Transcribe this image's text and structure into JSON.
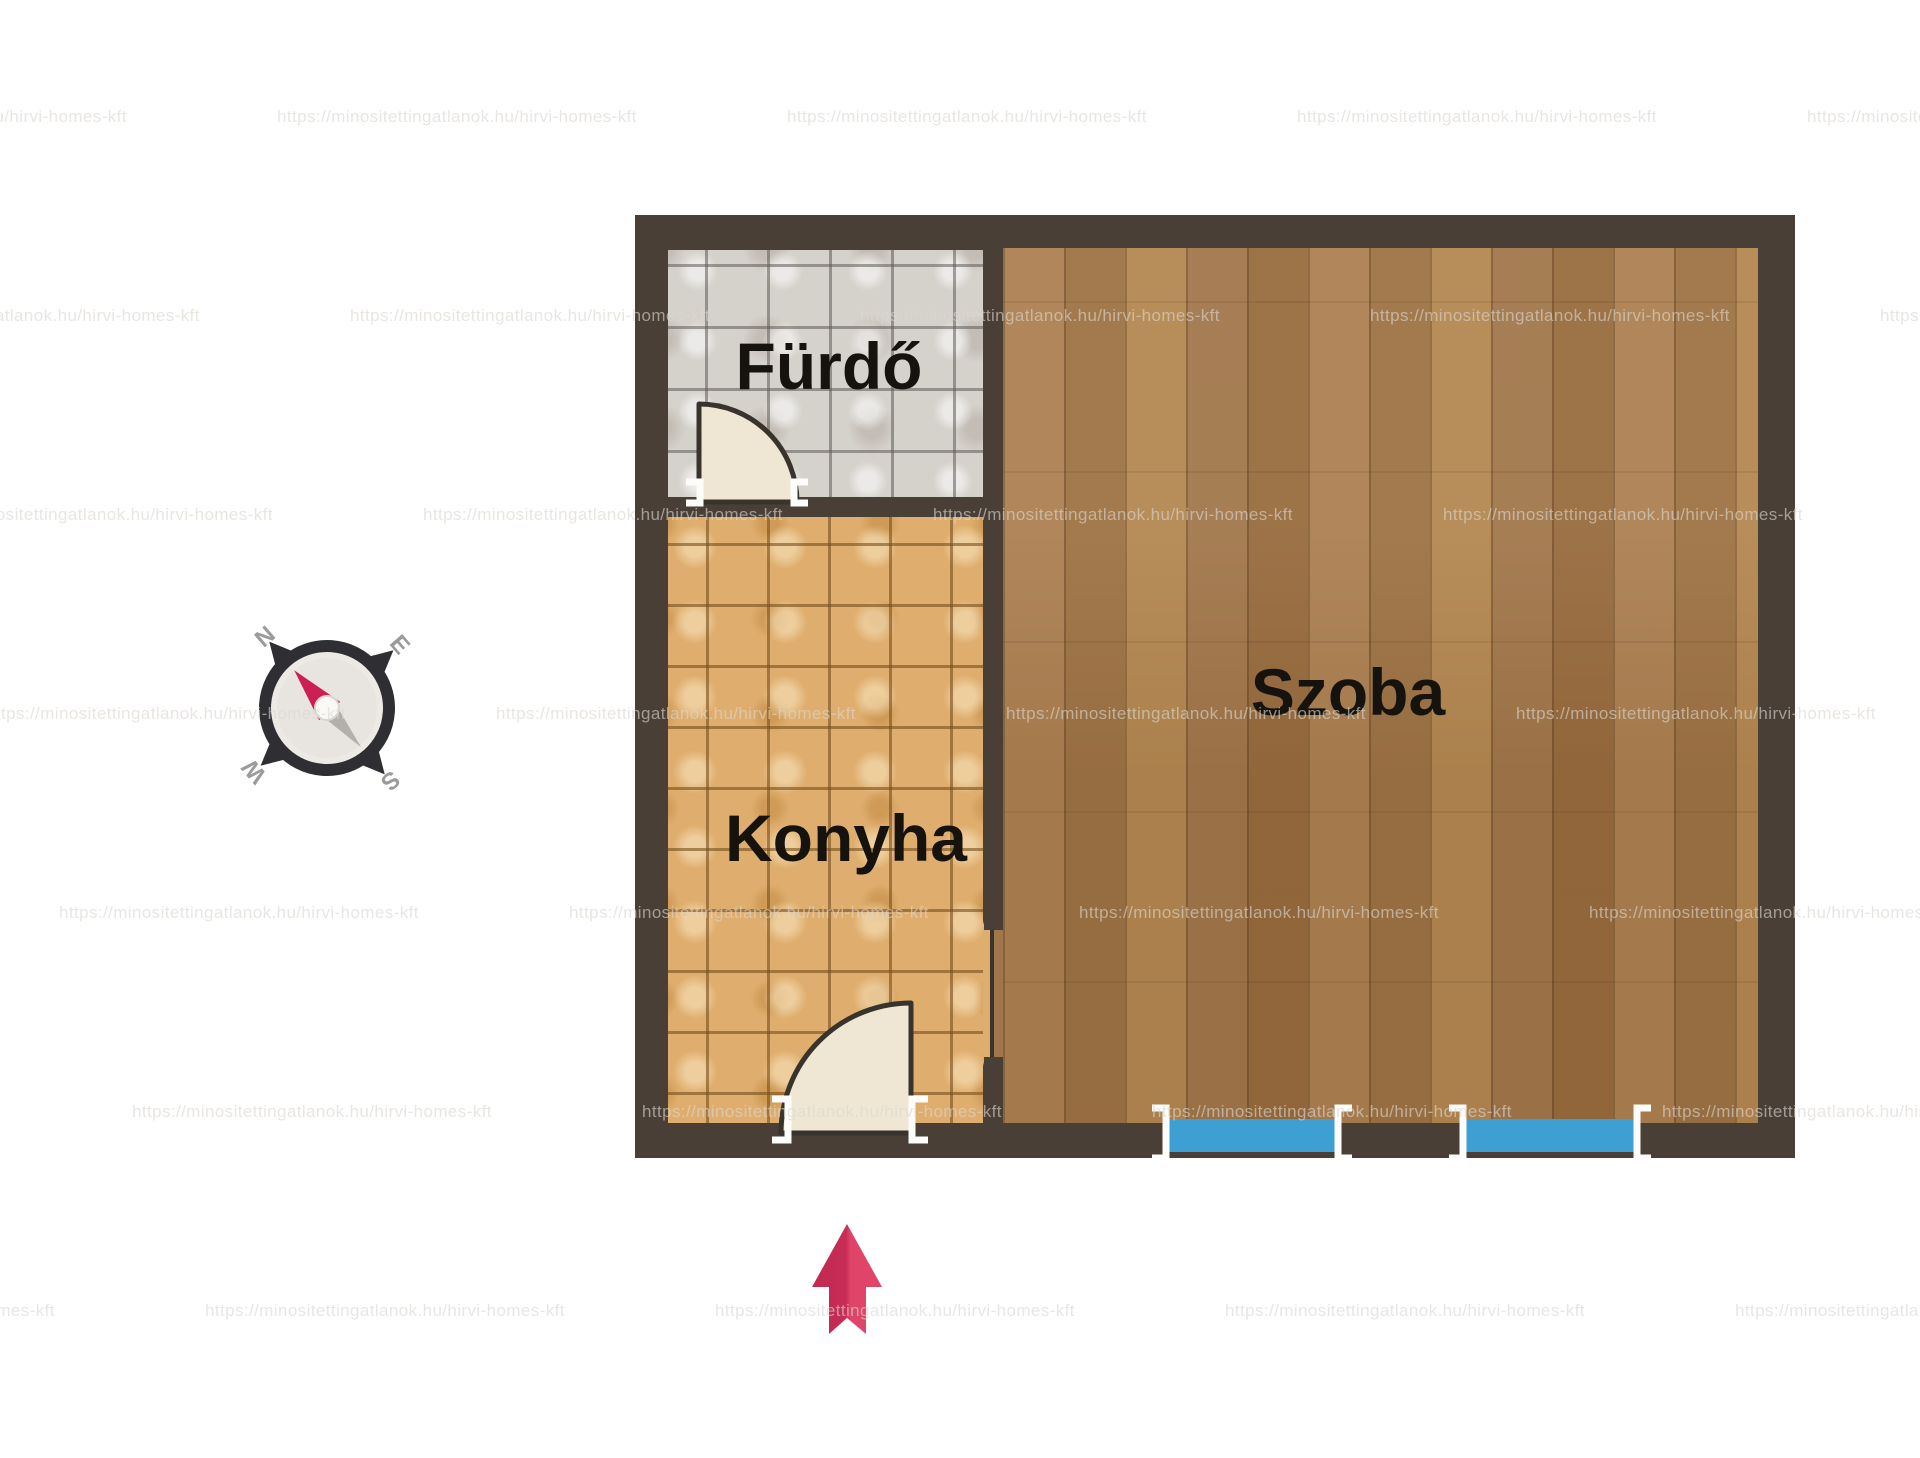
{
  "title": "Apartment floor plan",
  "floorplan": {
    "rooms": [
      {
        "id": "furdo",
        "name": "Fürdő",
        "type": "bathroom"
      },
      {
        "id": "konyha",
        "name": "Konyha",
        "type": "kitchen"
      },
      {
        "id": "szoba",
        "name": "Szoba",
        "type": "living-room"
      }
    ],
    "compass": {
      "north": "N",
      "east": "E",
      "south": "S",
      "west": "W"
    },
    "watermark": {
      "text": "https://minositettingatlanok.hu/hirvi-homes-kft",
      "rows": 7,
      "row_start_y": 107,
      "row_step_y": 199,
      "col_step_x": 510,
      "row_x_base": 277,
      "row_x_shift": 73
    },
    "colors": {
      "wall": "#493f37",
      "bathroom_tile": "#d5d1cb",
      "kitchen_tile": "#dfae6e",
      "wood_floor": "#a87c4e",
      "window_blue": "#3ea0d2",
      "door_leaf": "#efe7d4",
      "door_outline": "#39332d",
      "arrow_dark": "#c22a52",
      "arrow_light": "#e04468",
      "compass_ring": "#2e2e33",
      "compass_needle_red": "#cc2053",
      "label_text": "#16130f"
    }
  }
}
